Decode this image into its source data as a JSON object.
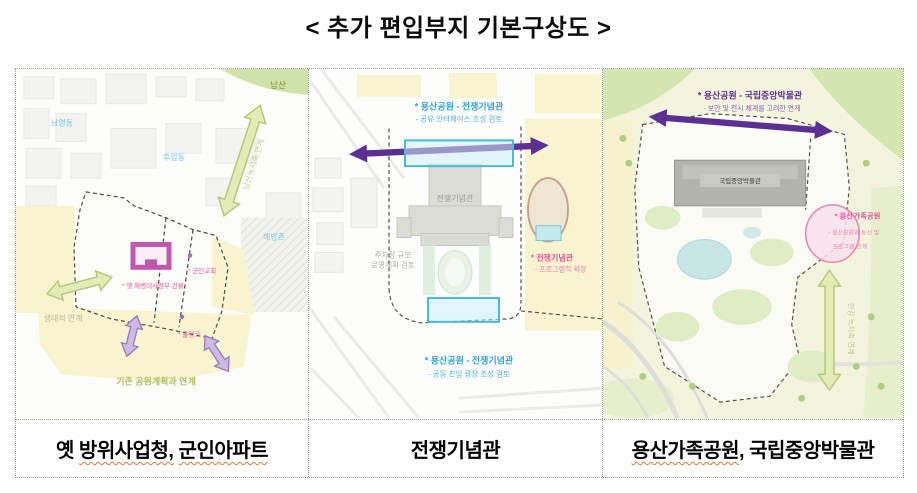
{
  "title": "<  추가  편입부지  기본구상도  >",
  "colors": {
    "accent_purple_arrow": "#5c2f93",
    "purple_text": "#5f2d91",
    "blue_text": "#2f9fd6",
    "pink_text": "#e8559a",
    "green_arrow_fill": "#e3ecb4",
    "purple_arrow_fill": "#cdb9e2",
    "olive_text": "#aebf63",
    "map_yellow": "#f8f4d0",
    "map_green": "#d4e6b0",
    "magenta_building": "#c257ae",
    "cyan_zone": "#4ab8d6",
    "wavy_underline": "#e07b39"
  },
  "panel1": {
    "caption": {
      "pre": "옛 ",
      "wavy1": "방위사업청,",
      "mid": " ",
      "wavy2": "군인아파트"
    },
    "labels": {
      "namsan": "남산",
      "namyeongdong": "남영동",
      "huamdong": "후암동",
      "haebangchon": "해방촌",
      "namsan_axis": "남산녹지축 연계",
      "eco_link": "생태적 연계",
      "hq_building": "* 옛 해병대사령부 건물",
      "church": "* 군인교회",
      "watertank": "* 물탱크",
      "park_plan_link": "기존 공원계획과 연계"
    }
  },
  "panel2": {
    "caption": {
      "pre": "전쟁기념관",
      "wavy1": "",
      "mid": "",
      "wavy2": ""
    },
    "labels": {
      "top_title": "* 용산공원 - 전쟁기념관",
      "top_sub": "- 공유 인터페이스 조성 검토",
      "building": "전쟁기념관",
      "parking_line1": "주차장 규모",
      "parking_line2": "운영계획 검토",
      "memorial_title": "* 전쟁기념관",
      "memorial_sub": "- 프로그램적 확장",
      "bottom_title": "* 용산공원 - 전쟁기념관",
      "bottom_sub": "- 공동 진입 광장 조성 검토"
    }
  },
  "panel3": {
    "caption": {
      "pre": "",
      "wavy1": "용산가족공원",
      "mid": ", 국립중앙박물관",
      "wavy2": ""
    },
    "labels": {
      "top_title": "* 용산공원 - 국립중앙박물관",
      "top_sub": "- 보안 및 전시 체계를 고려한 연계",
      "museum": "국립중앙박물관",
      "family_park_title": "* 용산가족공원",
      "family_park_sub1": "- 용산공원과 동선 및",
      "family_park_sub2": "프로그램 연계",
      "han_river_axis": "한강 녹지축 연계"
    }
  }
}
